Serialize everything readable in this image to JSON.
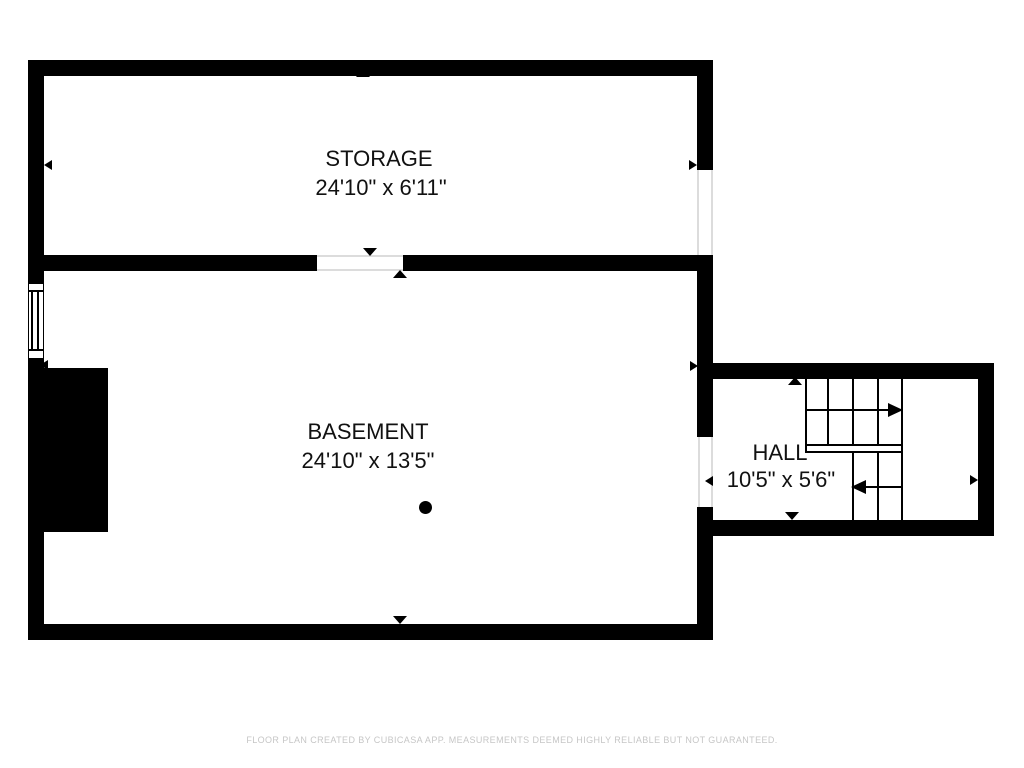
{
  "plan": {
    "rooms": [
      {
        "id": "storage",
        "name": "STORAGE",
        "dimensions": "24'10\" x 6'11\""
      },
      {
        "id": "basement",
        "name": "BASEMENT",
        "dimensions": "24'10\" x 13'5\""
      },
      {
        "id": "hall",
        "name": "HALL",
        "dimensions": "10'5\" x 5'6\""
      }
    ],
    "colors": {
      "wall": "#000000",
      "background": "#ffffff",
      "label_text": "#111111",
      "footer_text": "#c6c6c6",
      "opening_line": "#dcdcdc"
    }
  },
  "footer": {
    "disclaimer": "FLOOR PLAN CREATED BY CUBICASA APP. MEASUREMENTS DEEMED HIGHLY RELIABLE BUT NOT GUARANTEED."
  }
}
